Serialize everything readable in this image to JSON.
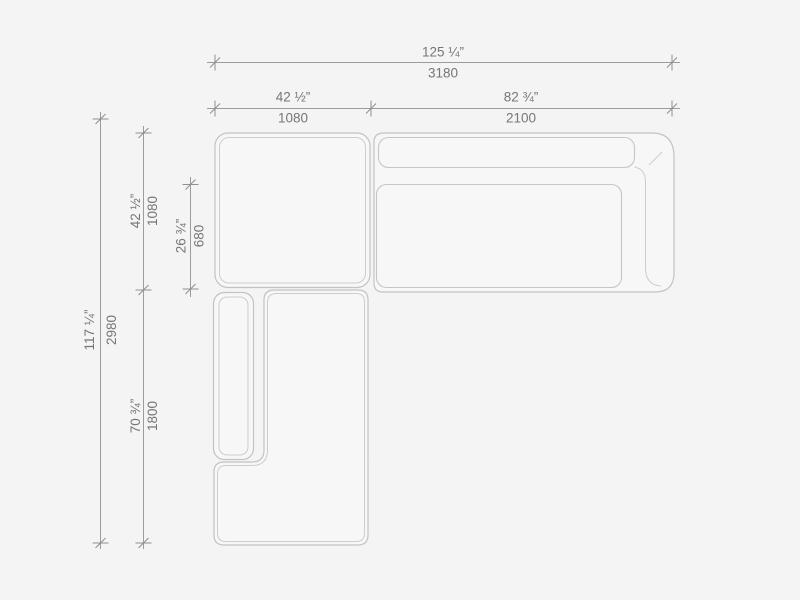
{
  "drawing": {
    "type": "sectional-sofa-top-view-dimension-drawing",
    "units": [
      "inches",
      "millimeters"
    ]
  },
  "colors": {
    "background": "#f4f4f4",
    "dimension_line": "#9c9c9c",
    "module_outline": "#c3c3c3",
    "label_text": "#767676"
  },
  "dimensions": {
    "overall_width": {
      "inches": "125 ¼”",
      "mm": "3180"
    },
    "left_module_width": {
      "inches": "42 ½”",
      "mm": "1080"
    },
    "right_module_width": {
      "inches": "82 ¾”",
      "mm": "2100"
    },
    "overall_depth": {
      "inches": "117 ¼”",
      "mm": "2980"
    },
    "upper_module_depth": {
      "inches": "42 ½”",
      "mm": "1080"
    },
    "seat_depth": {
      "inches": "26 ¾”",
      "mm": "680"
    },
    "lower_module_depth": {
      "inches": "70 ¾”",
      "mm": "1800"
    }
  }
}
